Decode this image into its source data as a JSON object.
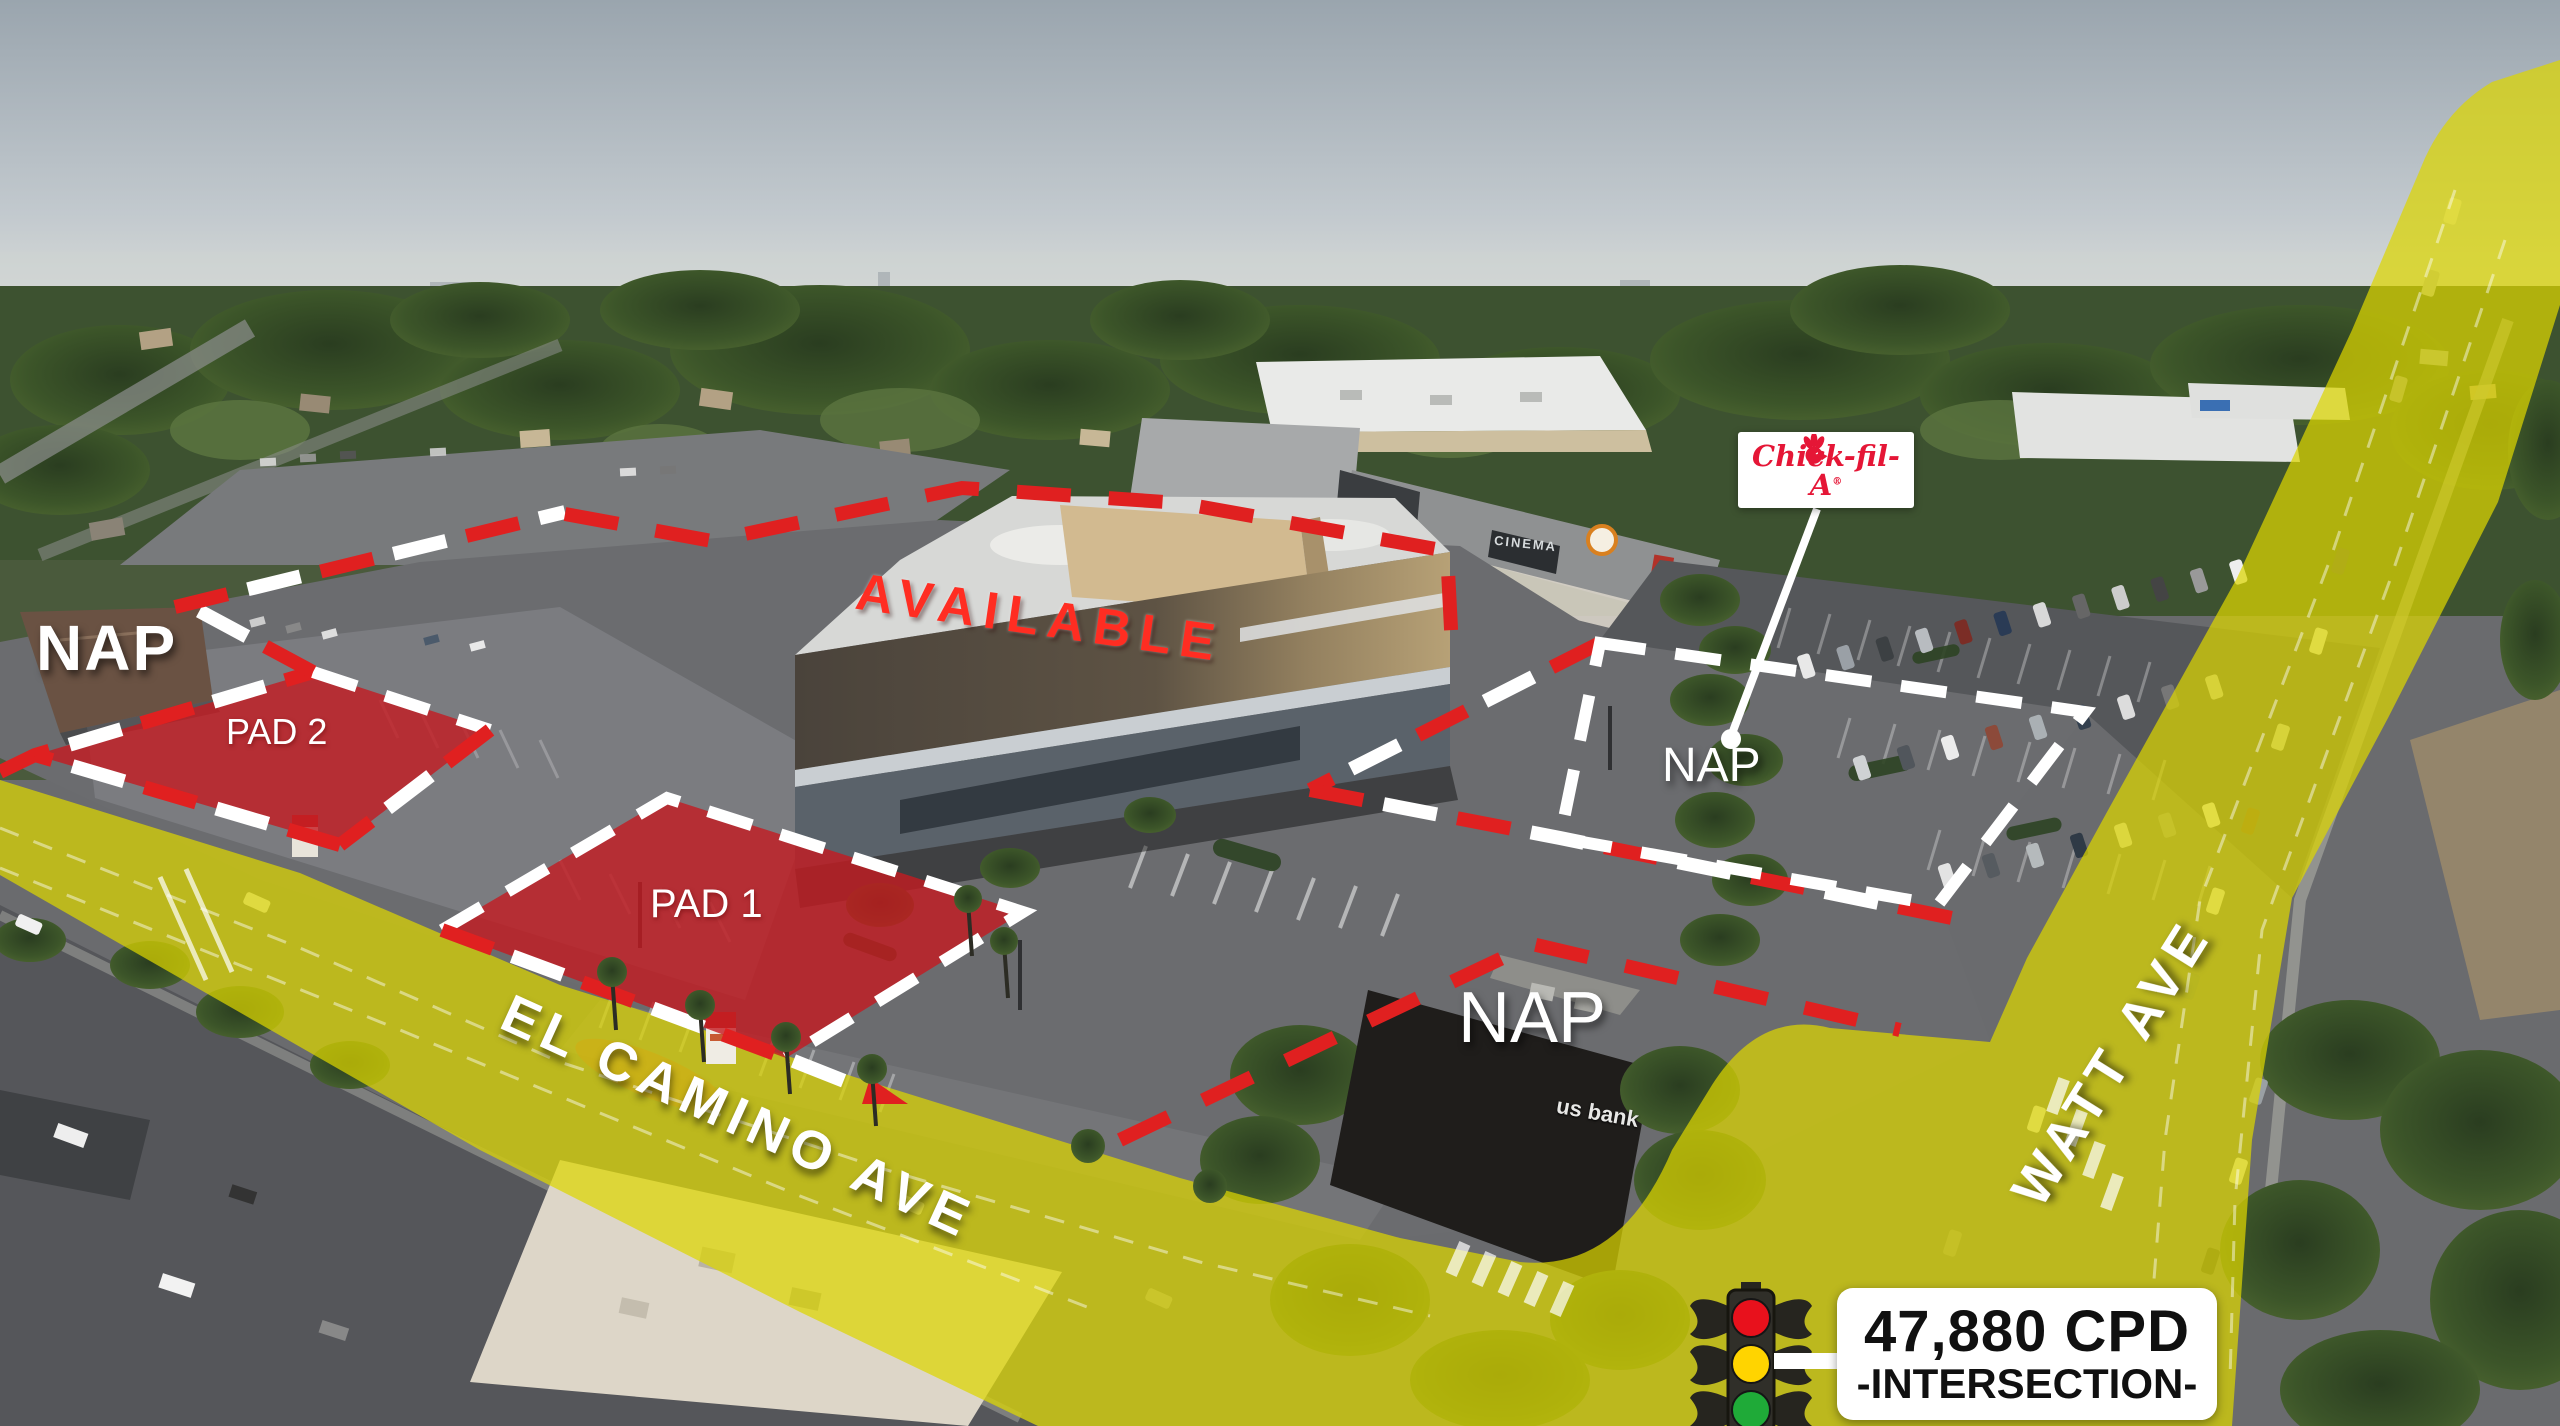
{
  "overlays": {
    "nap_top_left": "NAP",
    "pad_2": "PAD 2",
    "pad_1": "PAD 1",
    "nap_center": "NAP",
    "nap_bank": "NAP",
    "available": "AVAILABLE"
  },
  "streets": {
    "el_camino": "EL CAMINO AVE",
    "watt": "WATT AVE"
  },
  "signs": {
    "cinema": "CINEMA",
    "us_bank": "us bank"
  },
  "chick_fil_a": {
    "name": "Chick-fil-A",
    "registered": "®"
  },
  "traffic_callout": {
    "cpd": "47,880 CPD",
    "intersection": "-INTERSECTION-"
  },
  "colors": {
    "road_highlight": "#ddd600",
    "boundary_red": "#e02020",
    "pad_red": "#c41a20",
    "dash_white": "#ffffff",
    "available_red": "#ff2d22",
    "brand_red": "#e51636",
    "signal_red": "#e8111c",
    "signal_amber": "#ffd400",
    "signal_green": "#1faa38"
  }
}
